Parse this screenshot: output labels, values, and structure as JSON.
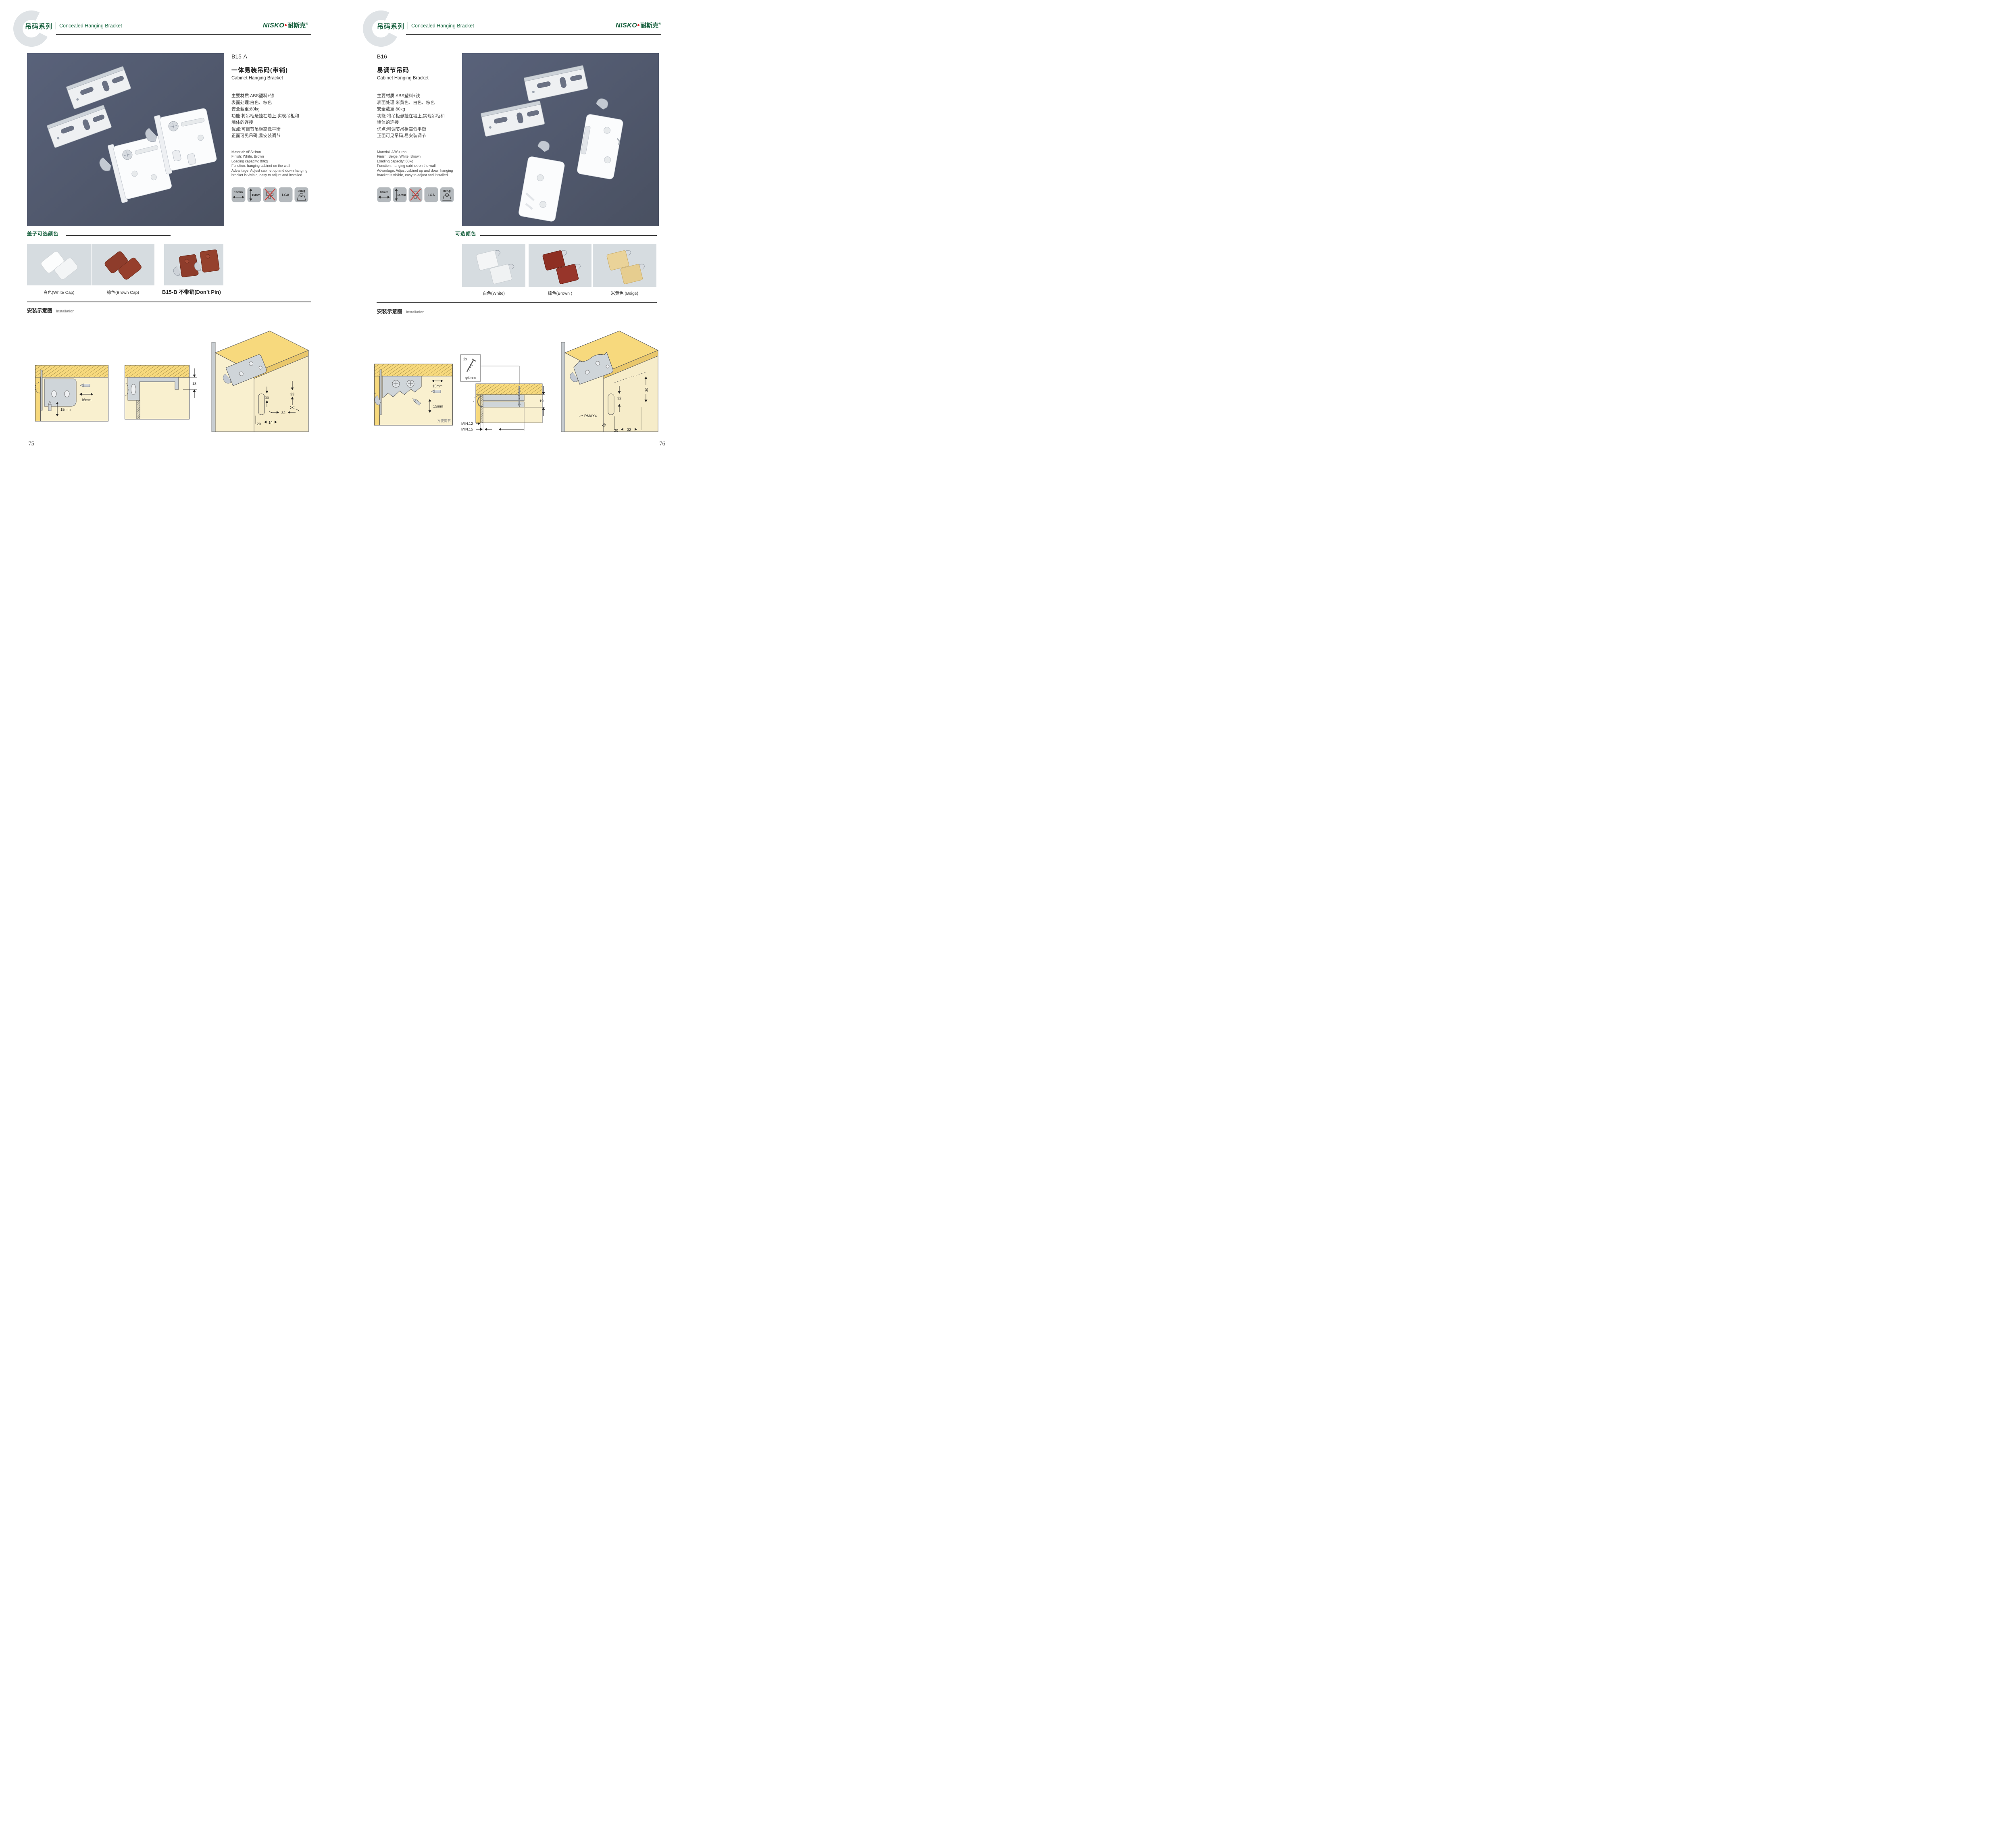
{
  "palette": {
    "accent_green": "#17603e",
    "header_rule": "#3a3a3a",
    "photo_background": "#4e576a",
    "swatch_background": "#d6dce0",
    "icon_tile_gray": "#b4b9bd",
    "diagram_wood": "#f7d97d",
    "diagram_cream": "#f9f0cf",
    "bracket_gray": "#cfd5d9",
    "no_drill_red": "#d03a34",
    "brand_red": "#e02425"
  },
  "page_left": {
    "page_number": "75",
    "header": {
      "series_cn": "吊码系列",
      "series_en": "Concealed Hanging Bracket",
      "brand_en": "NISKO",
      "brand_cn": "耐斯克",
      "brand_reg": "®"
    },
    "product": {
      "model": "B15-A",
      "title_cn": "一体易装吊码(带销)",
      "title_en": "Cabinet Hanging Bracket",
      "specs_cn": [
        "主要材质:ABS塑料+铁",
        "表面处理:白色、棕色",
        "安全载重:80kg",
        "功能:将吊柜悬挂在墙上,实现吊柜和",
        "墙体的连接",
        "优点:可调节吊柜高低平衡",
        "正面可见吊码,易安装调节"
      ],
      "specs_en": [
        "Material: ABS+iron",
        "Finish: White, Brown",
        "Loading capacity: 80kg",
        "Function: hanging cabinet on the wall",
        "Advantage: Adjust cabinet up and down hanging",
        "bracket is visible, easy to adjust and installed"
      ],
      "icons": [
        {
          "name": "width",
          "label": "16mm"
        },
        {
          "name": "height",
          "label": "15mm"
        },
        {
          "name": "no-drill",
          "label": ""
        },
        {
          "name": "certificate",
          "label": "LGA"
        },
        {
          "name": "load",
          "label": "80Kg"
        }
      ]
    },
    "colors": {
      "heading": "盖子可选颜色",
      "captions": [
        "白色(White Cap)",
        "棕色(Brown Cap)",
        "B15-B 不带销(Don’t Pin)"
      ]
    },
    "installation": {
      "heading_cn": "安装示意图",
      "heading_en": "Installation",
      "diag1": {
        "dim_width": "16mm",
        "dim_height": "15mm"
      },
      "diag2": {
        "dim": "18"
      },
      "diag3": {
        "d33": "33",
        "d30": "30",
        "d32": "32",
        "d20": "20",
        "d14": "14"
      }
    }
  },
  "page_right": {
    "page_number": "76",
    "header": {
      "series_cn": "吊码系列",
      "series_en": "Concealed Hanging Bracket",
      "brand_en": "NISKO",
      "brand_cn": "耐斯克",
      "brand_reg": "®"
    },
    "product": {
      "model": "B16",
      "title_cn": "易调节吊码",
      "title_en": "Cabinet Hanging Bracket",
      "specs_cn": [
        "主要材质:ABS塑料+铁",
        "表面处理:米黄色、白色、棕色",
        "安全载重:80kg",
        "功能:将吊柜悬挂在墙上,实现吊柜和",
        "墙体的连接",
        "优点:可调节吊柜高低平衡",
        "正面可见吊码,易安装调节"
      ],
      "specs_en": [
        "Material: ABS+iron",
        "Finish: Beige, White, Brown",
        "Loading capacity: 80kg",
        "Function: hanging cabinet on the wall",
        "Advantage: Adjust cabinet up and down hanging",
        "bracket is visible, easy to adjust and installed"
      ],
      "icons": [
        {
          "name": "width",
          "label": "10mm"
        },
        {
          "name": "height",
          "label": "15mm"
        },
        {
          "name": "no-drill",
          "label": ""
        },
        {
          "name": "certificate",
          "label": "LGA"
        },
        {
          "name": "load",
          "label": "80Kg"
        }
      ]
    },
    "colors": {
      "heading": "可选颜色",
      "captions": [
        "白色(White)",
        "棕色(Brown )",
        "米黄色 (Beige)"
      ]
    },
    "installation": {
      "heading_cn": "安装示意图",
      "heading_en": "Installation",
      "diag1": {
        "dim_width": "15mm",
        "dim_height": "15mm",
        "note": "方便调节"
      },
      "diag2": {
        "qty": "2x",
        "diameter": "φ4mm",
        "dim": "19",
        "min_a": "MIN.12",
        "min_b": "MIN.15"
      },
      "diag3": {
        "d30": "30",
        "d32": "32",
        "rmax": "RMAX4",
        "d19": "19",
        "d20": "20",
        "d32b": "32"
      }
    }
  }
}
